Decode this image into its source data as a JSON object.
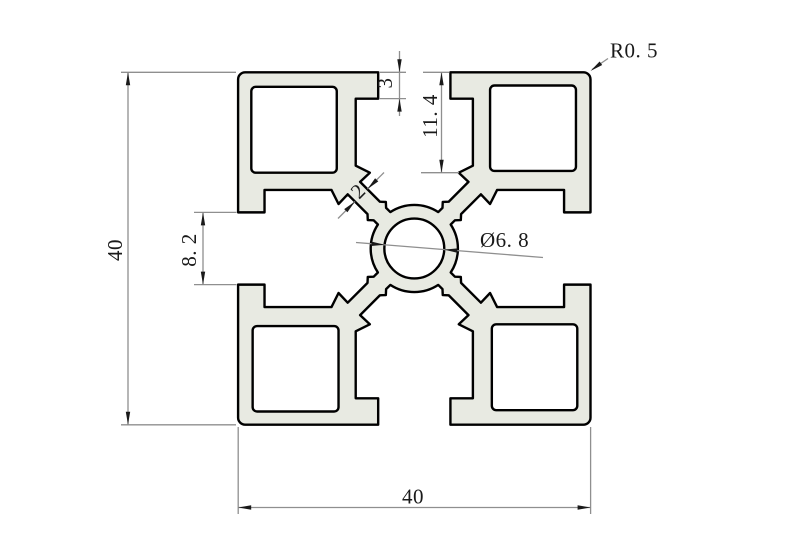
{
  "drawing": {
    "type": "engineering-cross-section",
    "subject": "40x40 T-slot aluminum extrusion profile"
  },
  "colors": {
    "background": "#ffffff",
    "profile_fill": "#e8eae2",
    "outline": "#000000",
    "dimension_lines": "#8f8f8f",
    "text": "#1a1a1a"
  },
  "dimensions": {
    "overall_height": {
      "label": "40"
    },
    "overall_width": {
      "label": "40"
    },
    "slot_opening": {
      "label": "8. 2"
    },
    "lip_height": {
      "label": "3"
    },
    "slot_depth": {
      "label": "11. 4"
    },
    "web_thickness": {
      "label": "2"
    },
    "center_bore": {
      "label": "Ø6. 8"
    },
    "corner_radius": {
      "label": "R0. 5"
    }
  },
  "profile_geometry_mm": {
    "size": 40,
    "slot_opening": 8.2,
    "lip_depth": 3,
    "slot_halfwidth": 6.65,
    "slot_depth": 11.4,
    "web_thickness": 2,
    "bore_diameter": 6.8,
    "hub_radius": 4.95,
    "corner_radius_draw": 0.8,
    "cavity": {
      "x1": 8.6,
      "y1": -18.5,
      "x2": 18.35,
      "y2": -8.8,
      "r": 0.5
    }
  }
}
